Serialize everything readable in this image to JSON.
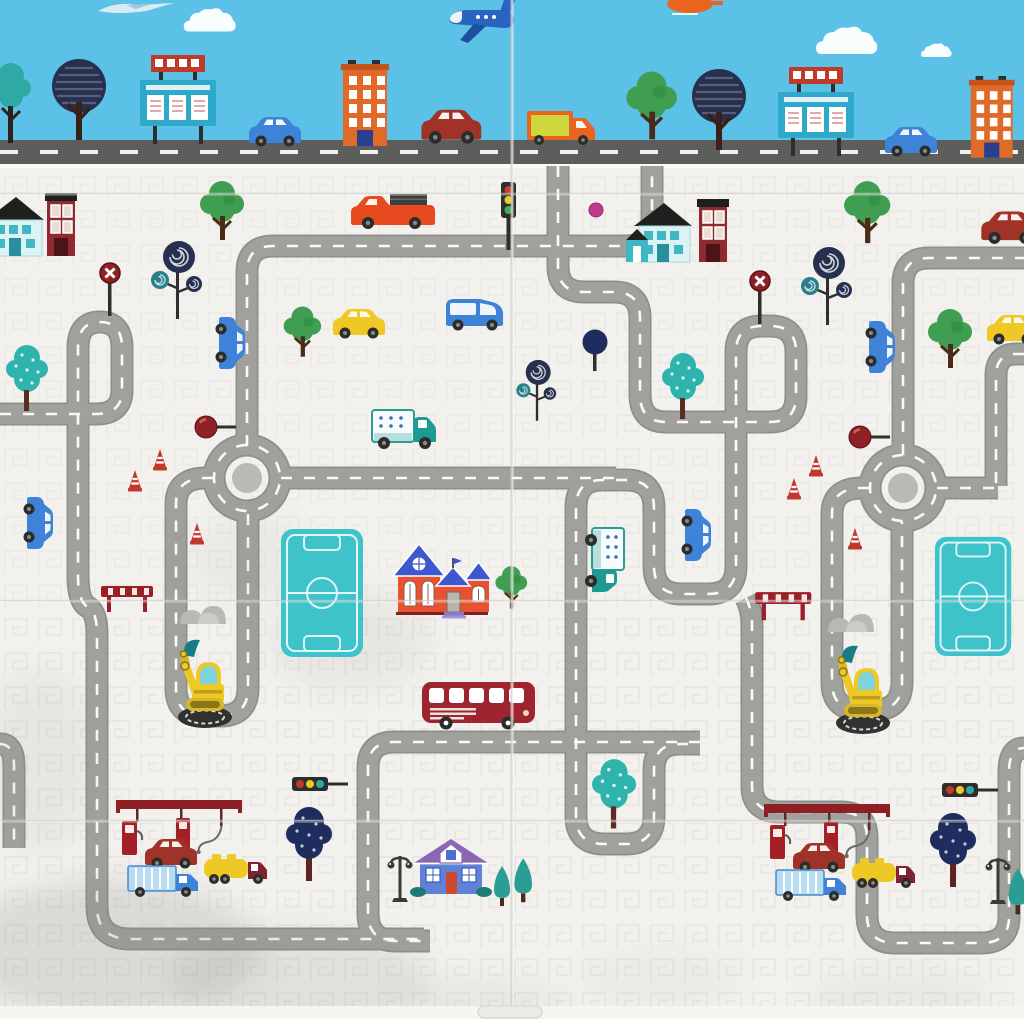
{
  "palette": {
    "sky": "#5cc1e6",
    "sky_road": "#5d5d5b",
    "sky_road_dash": "#ffffff",
    "mat": "#f2f1ed",
    "texture": "#e3e2dd",
    "road": "#a0a09d",
    "road_edge": "#8e8e8b",
    "road_dash": "#ffffff",
    "disc": "#b9b9b6",
    "seam": "#d2d0cc",
    "boundary": "#fafaf8",
    "edge_strip": "#f6f5f2",
    "smudge": "#8a887f"
  },
  "scene": {
    "sky_objects": [
      {
        "t": "plane-small",
        "x": 96,
        "y": 1
      },
      {
        "t": "cloud",
        "x": 182,
        "y": 6,
        "s": 0.85
      },
      {
        "t": "plane-blue",
        "x": 444,
        "y": -2,
        "fx": true
      },
      {
        "t": "heli-orange",
        "x": 664,
        "y": -6
      },
      {
        "t": "cloud",
        "x": 814,
        "y": 24
      },
      {
        "t": "cloud",
        "x": 920,
        "y": 42,
        "s": 0.5
      },
      {
        "t": "tree-bush-teal",
        "x": -8,
        "y": 60
      },
      {
        "t": "tree-navy",
        "x": 48,
        "y": 54
      },
      {
        "t": "billboard",
        "x": 136,
        "y": 52
      },
      {
        "t": "building-orange",
        "x": 340,
        "y": 60
      },
      {
        "t": "car",
        "c": "#3f83d8",
        "x": 246,
        "y": 112
      },
      {
        "t": "car",
        "c": "#a03328",
        "x": 418,
        "y": 104,
        "s": 1.15
      },
      {
        "t": "van-orange",
        "x": 524,
        "y": 106
      },
      {
        "t": "tree-green",
        "x": 624,
        "y": 68,
        "s": 1.15
      },
      {
        "t": "tree-navy",
        "x": 688,
        "y": 64
      },
      {
        "t": "billboard",
        "x": 774,
        "y": 64
      },
      {
        "t": "car",
        "c": "#3f83d8",
        "x": 882,
        "y": 122
      },
      {
        "t": "building-orange",
        "x": 968,
        "y": 76,
        "s": 0.95
      }
    ],
    "mat_objects": [
      {
        "t": "house-teal",
        "x": -22,
        "y": 194
      },
      {
        "t": "house-tall-red",
        "x": 42,
        "y": 190
      },
      {
        "t": "tree-green",
        "x": 198,
        "y": 178
      },
      {
        "t": "lollipop",
        "x": 148,
        "y": 236
      },
      {
        "t": "sign-x",
        "x": 98,
        "y": 262
      },
      {
        "t": "pickup",
        "x": 348,
        "y": 192
      },
      {
        "t": "traffic-light-v",
        "x": 498,
        "y": 180
      },
      {
        "t": "dot-magenta",
        "x": 588,
        "y": 202
      },
      {
        "t": "house-teal",
        "x": 626,
        "y": 200
      },
      {
        "t": "house-tall-red",
        "x": 694,
        "y": 196
      },
      {
        "t": "tree-green",
        "x": 842,
        "y": 178,
        "s": 1.05
      },
      {
        "t": "lollipop",
        "x": 798,
        "y": 242
      },
      {
        "t": "sign-x",
        "x": 748,
        "y": 270
      },
      {
        "t": "car",
        "c": "#a03328",
        "x": 978,
        "y": 206,
        "s": 1.1
      },
      {
        "t": "tree-teal-dotted",
        "x": 6,
        "y": 342
      },
      {
        "t": "car",
        "c": "#3f83d8",
        "x": 216,
        "y": 314,
        "rot": 90
      },
      {
        "t": "tree-green",
        "x": 282,
        "y": 304,
        "s": 0.85
      },
      {
        "t": "car",
        "c": "#eec824",
        "x": 330,
        "y": 304
      },
      {
        "t": "van-blue",
        "x": 442,
        "y": 290
      },
      {
        "t": "ball-tree",
        "x": 580,
        "y": 328
      },
      {
        "t": "lollipop",
        "x": 514,
        "y": 356,
        "s": 0.78
      },
      {
        "t": "tree-teal-dotted",
        "x": 662,
        "y": 350
      },
      {
        "t": "tree-green",
        "x": 926,
        "y": 306
      },
      {
        "t": "car",
        "c": "#eec824",
        "x": 984,
        "y": 310
      },
      {
        "t": "car",
        "c": "#3f83d8",
        "x": 866,
        "y": 318,
        "rot": 90
      },
      {
        "t": "sign-ball",
        "x": 194,
        "y": 414
      },
      {
        "t": "sign-ball",
        "x": 848,
        "y": 424
      },
      {
        "t": "truck-teal",
        "x": 370,
        "y": 406
      },
      {
        "t": "cone",
        "x": 152,
        "y": 448
      },
      {
        "t": "cone",
        "x": 127,
        "y": 469
      },
      {
        "t": "cone",
        "x": 189,
        "y": 522
      },
      {
        "t": "cone",
        "x": 808,
        "y": 454
      },
      {
        "t": "cone",
        "x": 786,
        "y": 477
      },
      {
        "t": "cone",
        "x": 847,
        "y": 527
      },
      {
        "t": "car",
        "c": "#3f83d8",
        "x": 24,
        "y": 494,
        "rot": 90
      },
      {
        "t": "car",
        "c": "#3f83d8",
        "x": 682,
        "y": 506,
        "rot": 90
      },
      {
        "t": "truck-teal",
        "x": 582,
        "y": 526,
        "rot": 90
      },
      {
        "t": "field",
        "x": 280,
        "y": 528
      },
      {
        "t": "field",
        "x": 934,
        "y": 536,
        "s": 0.93
      },
      {
        "t": "house-red-blue",
        "x": 392,
        "y": 536
      },
      {
        "t": "tree-green",
        "x": 494,
        "y": 564,
        "s": 0.72
      },
      {
        "t": "barrier",
        "x": 99,
        "y": 584
      },
      {
        "t": "barrier",
        "x": 753,
        "y": 590,
        "s": 1.08
      },
      {
        "t": "rocks",
        "x": 178,
        "y": 598
      },
      {
        "t": "rocks",
        "x": 826,
        "y": 606
      },
      {
        "t": "excavator",
        "x": 172,
        "y": 632
      },
      {
        "t": "excavator",
        "x": 830,
        "y": 638
      },
      {
        "t": "bus",
        "x": 420,
        "y": 678
      },
      {
        "t": "tree-teal-dotted",
        "x": 592,
        "y": 756,
        "s": 1.05
      },
      {
        "t": "tree-navy-dotted",
        "x": 286,
        "y": 804
      },
      {
        "t": "tree-navy-dotted",
        "x": 930,
        "y": 810
      },
      {
        "t": "traffic-light-h",
        "x": 292,
        "y": 776
      },
      {
        "t": "traffic-light-h",
        "x": 942,
        "y": 782
      },
      {
        "t": "gas-station",
        "x": 116,
        "y": 800
      },
      {
        "t": "gas-station",
        "x": 764,
        "y": 804
      },
      {
        "t": "car",
        "c": "#a03328",
        "x": 142,
        "y": 834
      },
      {
        "t": "car",
        "c": "#a03328",
        "x": 790,
        "y": 838
      },
      {
        "t": "truck-blue",
        "x": 126,
        "y": 862
      },
      {
        "t": "truck-blue",
        "x": 774,
        "y": 866
      },
      {
        "t": "tanker",
        "x": 202,
        "y": 852
      },
      {
        "t": "tanker",
        "x": 850,
        "y": 856
      },
      {
        "t": "lamp",
        "x": 386,
        "y": 848
      },
      {
        "t": "house-purple",
        "x": 410,
        "y": 836
      },
      {
        "t": "tree-cone",
        "x": 490,
        "y": 864
      },
      {
        "t": "tree-cone",
        "x": 510,
        "y": 856,
        "s": 1.1
      },
      {
        "t": "lamp",
        "x": 984,
        "y": 850
      },
      {
        "t": "tree-cone",
        "x": 1004,
        "y": 866,
        "s": 1.15
      }
    ]
  },
  "roads": {
    "sky_road": {
      "y": 140,
      "height": 24,
      "dash_y": 152
    },
    "paths": [
      "M 247,446 V 272 Q 247,246 273,246 H 626 Q 652,246 652,220 V 166",
      "M 558,166 V 266 Q 558,292 584,292 H 614 Q 640,292 640,318 V 394 Q 640,422 666,422 H 770 Q 796,422 796,396 V 352 Q 796,326 770,326 H 762 Q 736,326 736,352 V 394",
      "M 736,394 V 566 Q 736,594 708,594 H 682 Q 654,594 654,566 V 508 Q 654,480 626,480 H 602 Q 576,480 576,508 V 816 Q 576,844 604,844 H 626 Q 654,844 654,816 V 770 Q 654,744 680,744 H 700",
      "M 746,598 Q 752,610 752,624 V 786 Q 752,812 780,812 H 841 Q 867,812 867,838 V 915 Q 867,943 895,943 H 981 Q 1009,943 1009,917 V 772 Q 1009,748 1024,748",
      "M 700,742 H 394 Q 368,742 368,768 V 913 Q 368,941 396,941 H 430",
      "M 0,414 H 96 Q 122,414 122,390 V 348 Q 122,322 100,322 Q 78,322 78,348 V 576 Q 78,602 88,607 Q 97,612 97,634 V 906 Q 97,939 130,939 H 424",
      "M 0,744 Q 14,744 14,766 V 848",
      "M 281,478 H 616",
      "M 213,478 H 206 Q 176,478 176,504 V 688 Q 176,716 204,716 H 220 Q 248,716 248,688 V 512",
      "M 903,455 V 284 Q 903,258 929,258 H 1024",
      "M 869,488 H 862 Q 832,488 832,514 V 682 Q 832,710 860,710 H 874 Q 902,710 902,682 V 522",
      "M 937,488 H 998",
      "M 1024,354 H 1016 Q 996,354 996,376 V 486",
      "M 247,445 a 33,33 0 1 0 0.02,0",
      "M 903,455 a 33,33 0 1 0 0.02,0"
    ],
    "discs": [
      {
        "x": 247,
        "y": 478,
        "r": 15
      },
      {
        "x": 903,
        "y": 488,
        "r": 15
      }
    ]
  },
  "seams": {
    "vertical_x": 511,
    "horizontal_y": [
      193,
      600,
      820
    ]
  },
  "smudges": [
    {
      "x": 110,
      "y": 950,
      "rx": 150,
      "ry": 70,
      "o": 0.22
    },
    {
      "x": 40,
      "y": 760,
      "rx": 60,
      "ry": 90,
      "o": 0.1
    },
    {
      "x": 300,
      "y": 980,
      "rx": 130,
      "ry": 50,
      "o": 0.16
    },
    {
      "x": 350,
      "y": 640,
      "rx": 80,
      "ry": 50,
      "o": 0.1
    },
    {
      "x": 250,
      "y": 560,
      "rx": 60,
      "ry": 40,
      "o": 0.08
    },
    {
      "x": 480,
      "y": 1005,
      "rx": 90,
      "ry": 25,
      "o": 0.1
    },
    {
      "x": 900,
      "y": 1000,
      "rx": 90,
      "ry": 30,
      "o": 0.08
    },
    {
      "x": 660,
      "y": 980,
      "rx": 80,
      "ry": 30,
      "o": 0.06
    }
  ]
}
